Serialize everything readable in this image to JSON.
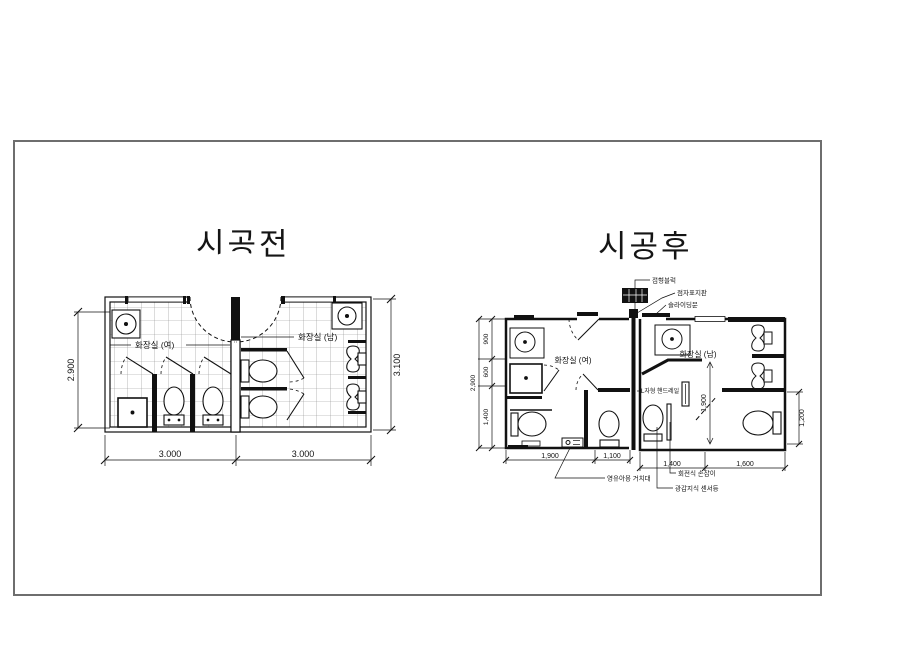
{
  "before": {
    "title": "시공전",
    "room_women": "화장실 (여)",
    "room_men": "화장실 (남)",
    "dim_width_women": "3.000",
    "dim_width_men": "3.000",
    "dim_height_left": "2.900",
    "dim_height_right": "3.100"
  },
  "after": {
    "title": "시공후",
    "room_women": "화장실 (여)",
    "room_men": "화장실 (남)",
    "dims": {
      "left_total": "2,900",
      "left_top": "900",
      "left_mid": "600",
      "left_bottom": "1,400",
      "women_bottom_left": "1,900",
      "women_bottom_right": "1,100",
      "men_bottom_left": "1,400",
      "men_bottom_right": "1,600",
      "men_inner_height": "1,900",
      "men_right_height": "1,200"
    },
    "annotations": {
      "tactile_block": "점형블럭",
      "braille_sign": "점자표지판",
      "sliding_door": "슬라이딩문",
      "l_handrail": "L자형 핸드레일",
      "infant_holder": "영유아용 거치대",
      "rotating_grab_bar": "회전식 손잡이",
      "sensor_light": "광감지식 센서등"
    }
  }
}
